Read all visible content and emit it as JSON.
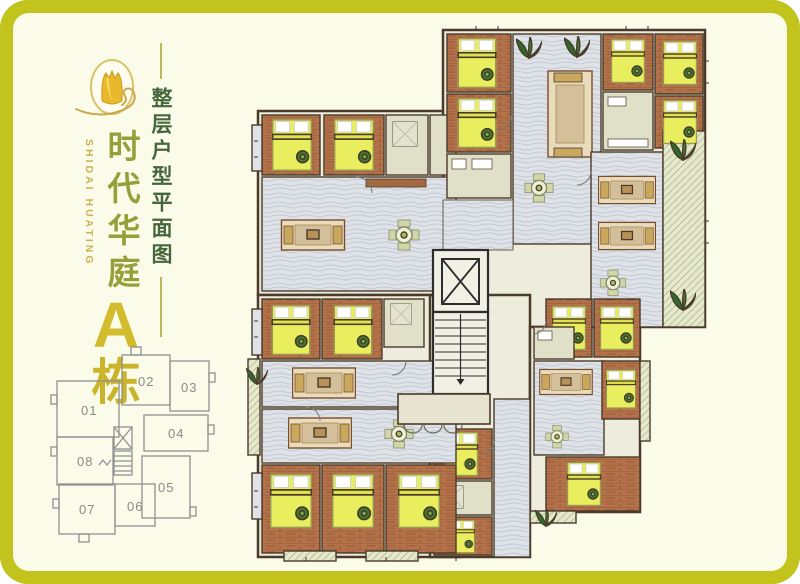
{
  "brand": {
    "logo": "tulip-logo",
    "name_en": "SHIDAI HUATING",
    "name_cn": "时代华庭",
    "building": "A",
    "building_suffix": "栋"
  },
  "title": {
    "text": "整层户型平面图"
  },
  "keyplan": {
    "units": [
      {
        "label": "01"
      },
      {
        "label": "02"
      },
      {
        "label": "03"
      },
      {
        "label": "04"
      },
      {
        "label": "05"
      },
      {
        "label": "06"
      },
      {
        "label": "07"
      },
      {
        "label": "08"
      }
    ]
  },
  "colors": {
    "frame_border": "#c3c31e",
    "panel_background": "#fbfbea",
    "brand_gold": "#d2bc2e",
    "brand_olive": "#96a03b",
    "title_green": "#46663c",
    "keyplan_gray": "#8a8a8a",
    "wall": "#4a3b2a",
    "wood_floor": "#b3724a",
    "bed_yellow": "#e9ee5e",
    "marble_gray": "#dfe2e7",
    "tile_beige": "#e0dfc8",
    "balcony_green": "#e6e9cd",
    "plant_green": "#2e6b2a",
    "sofa_tan": "#d3c09a"
  }
}
